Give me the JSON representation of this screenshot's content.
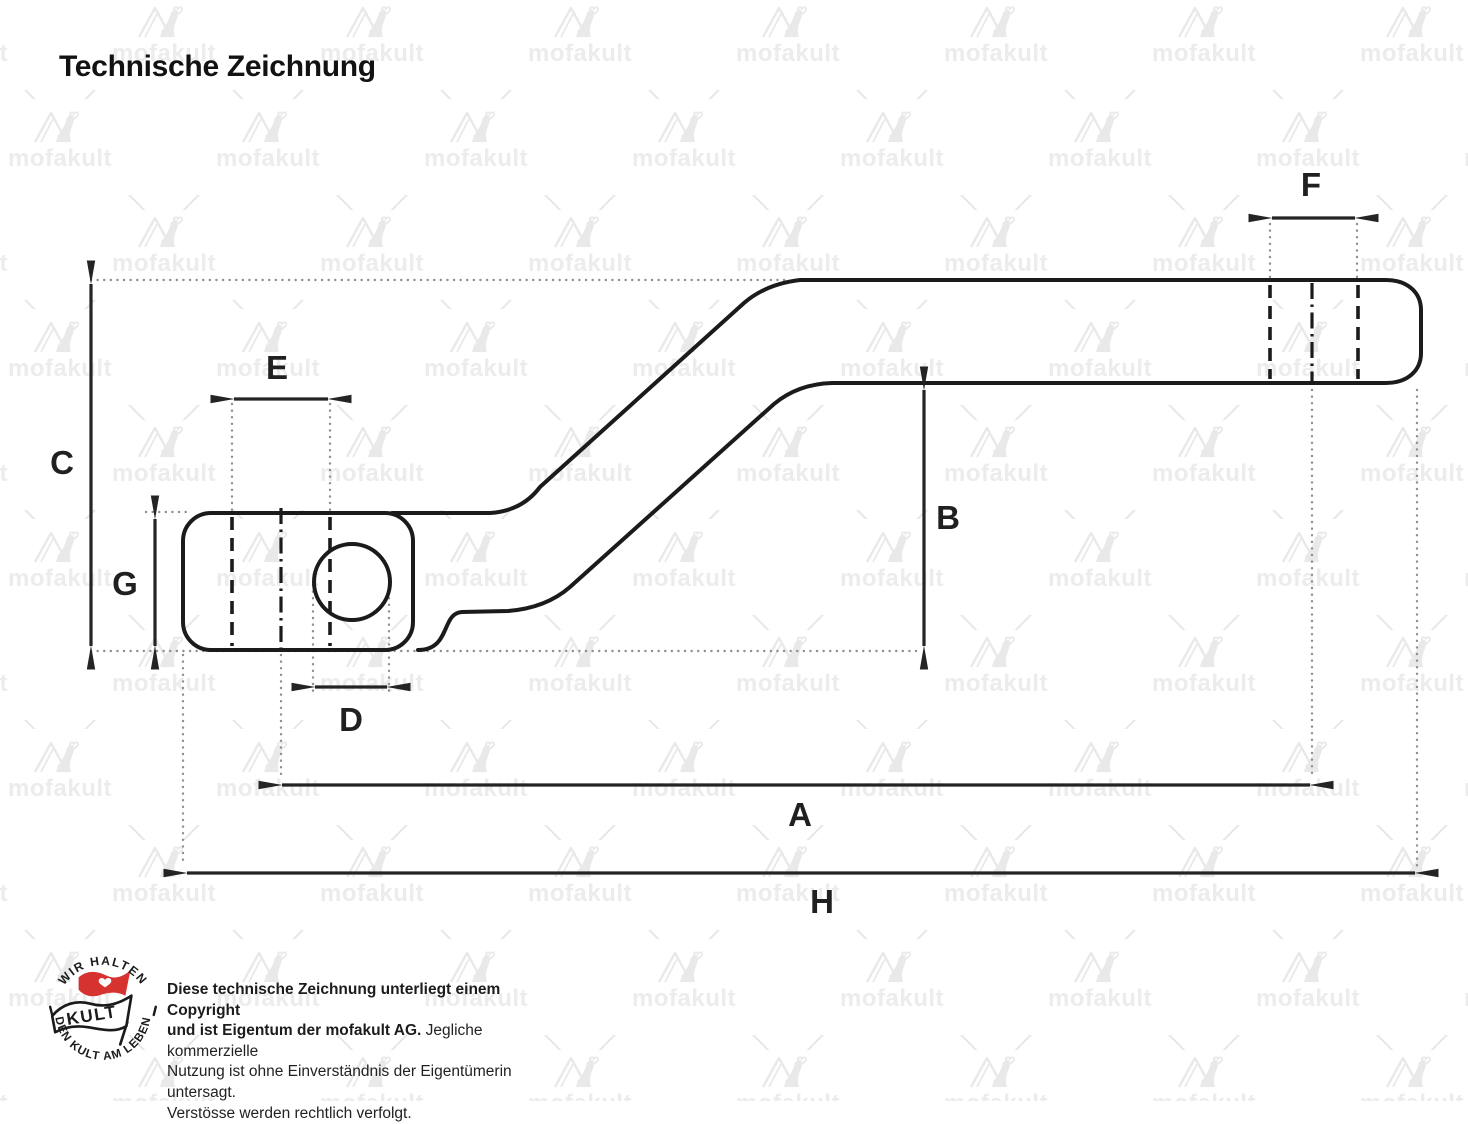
{
  "title": "Technische Zeichnung",
  "watermark": {
    "brand": "mofakult"
  },
  "drawing": {
    "type": "technical-drawing",
    "part": "kickstart-lever-side-view",
    "labels": {
      "A": "A",
      "B": "B",
      "C": "C",
      "D": "D",
      "E": "E",
      "F": "F",
      "G": "G",
      "H": "H"
    }
  },
  "logo": {
    "arc_top": "WIR HALTEN",
    "arc_bottom": "DEN KULT AM LEBEN",
    "flag_text": "KULT"
  },
  "copyright": {
    "line1_bold": "Diese technische Zeichnung unterliegt einem Copyright",
    "line2_bold": "und ist Eigentum der mofakult AG.",
    "line2_regular": " Jegliche kommerzielle",
    "line3": "Nutzung ist ohne Einverständnis der Eigentümerin untersagt.",
    "line4": "Verstösse werden rechtlich verfolgt."
  },
  "colors": {
    "outline": "#1b1b1b",
    "dimension": "#242424",
    "extension": "#8f8f8f",
    "watermark": "#e9e9e9",
    "logo_red": "#d63230",
    "background": "#ffffff"
  }
}
